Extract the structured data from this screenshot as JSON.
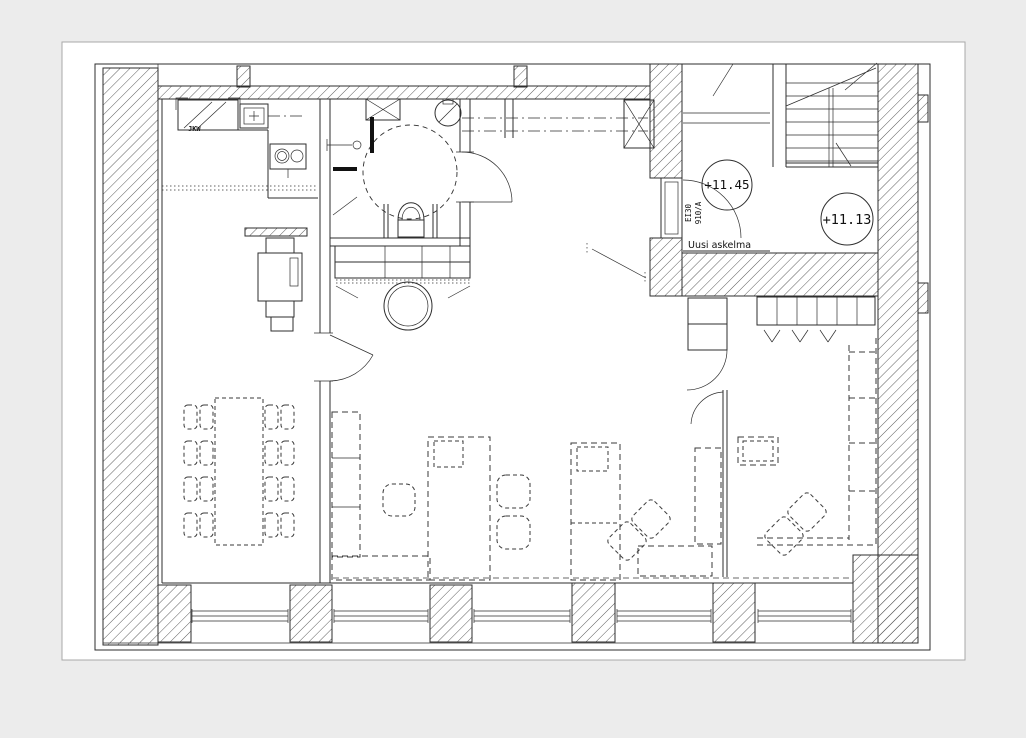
{
  "canvas": {
    "background": "#ececec",
    "sheet": "#ffffff",
    "ink": "#2e2e2e"
  },
  "floor_plan": {
    "level_markers": [
      {
        "id": "entry-landing",
        "label": "+11.45"
      },
      {
        "id": "stair-hall-lower",
        "label": "+11.13"
      }
    ],
    "annotations": {
      "new_step": "Uusi askelma",
      "door_tag_size": "910/A",
      "door_tag_fire": "EI30",
      "kitchen_appliance": "JKW"
    }
  }
}
